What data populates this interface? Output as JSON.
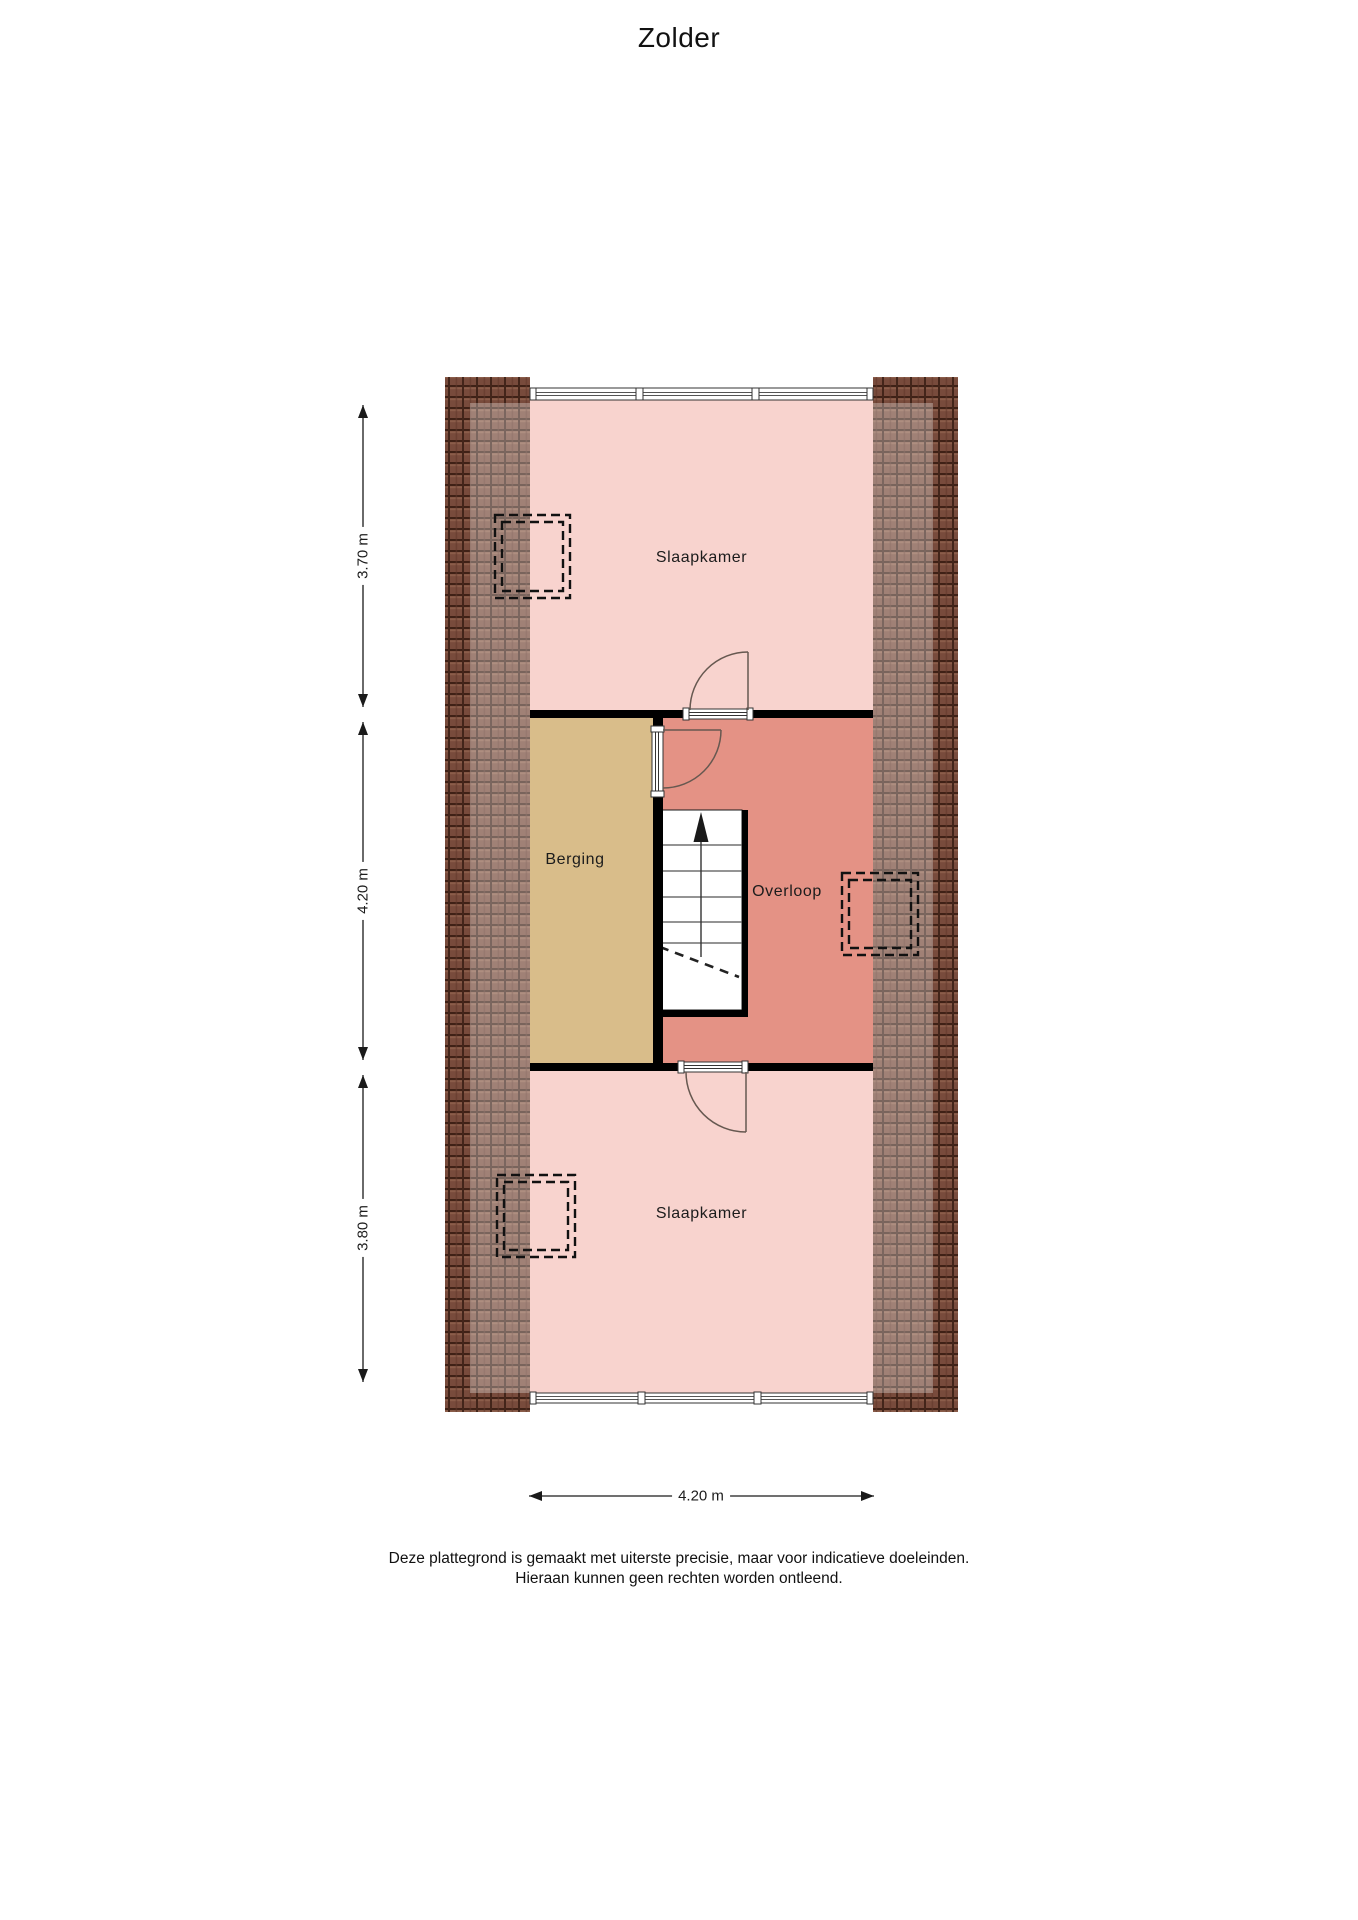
{
  "title": "Zolder",
  "rooms": {
    "slaapkamer_top": {
      "label": "Slaapkamer"
    },
    "berging": {
      "label": "Berging"
    },
    "overloop": {
      "label": "Overloop"
    },
    "slaapkamer_bottom": {
      "label": "Slaapkamer"
    }
  },
  "dimensions": {
    "slaapkamer_top_depth": "3.70 m",
    "middle_depth": "4.20 m",
    "slaapkamer_bottom_depth": "3.80 m",
    "plan_width": "4.20 m"
  },
  "stairs": {
    "direction_icon": "up-arrow"
  },
  "disclaimer": {
    "line1": "Deze plattegrond is gemaakt met uiterste precisie, maar voor indicatieve doeleinden.",
    "line2": "Hieraan kunnen geen rechten worden ontleend."
  },
  "colors": {
    "room_pink": "#f8d3ce",
    "overloop_salmon": "#e49285",
    "berging_tan": "#d9bd8a",
    "roof_brown": "#8a5948",
    "wall_black": "#000000"
  }
}
